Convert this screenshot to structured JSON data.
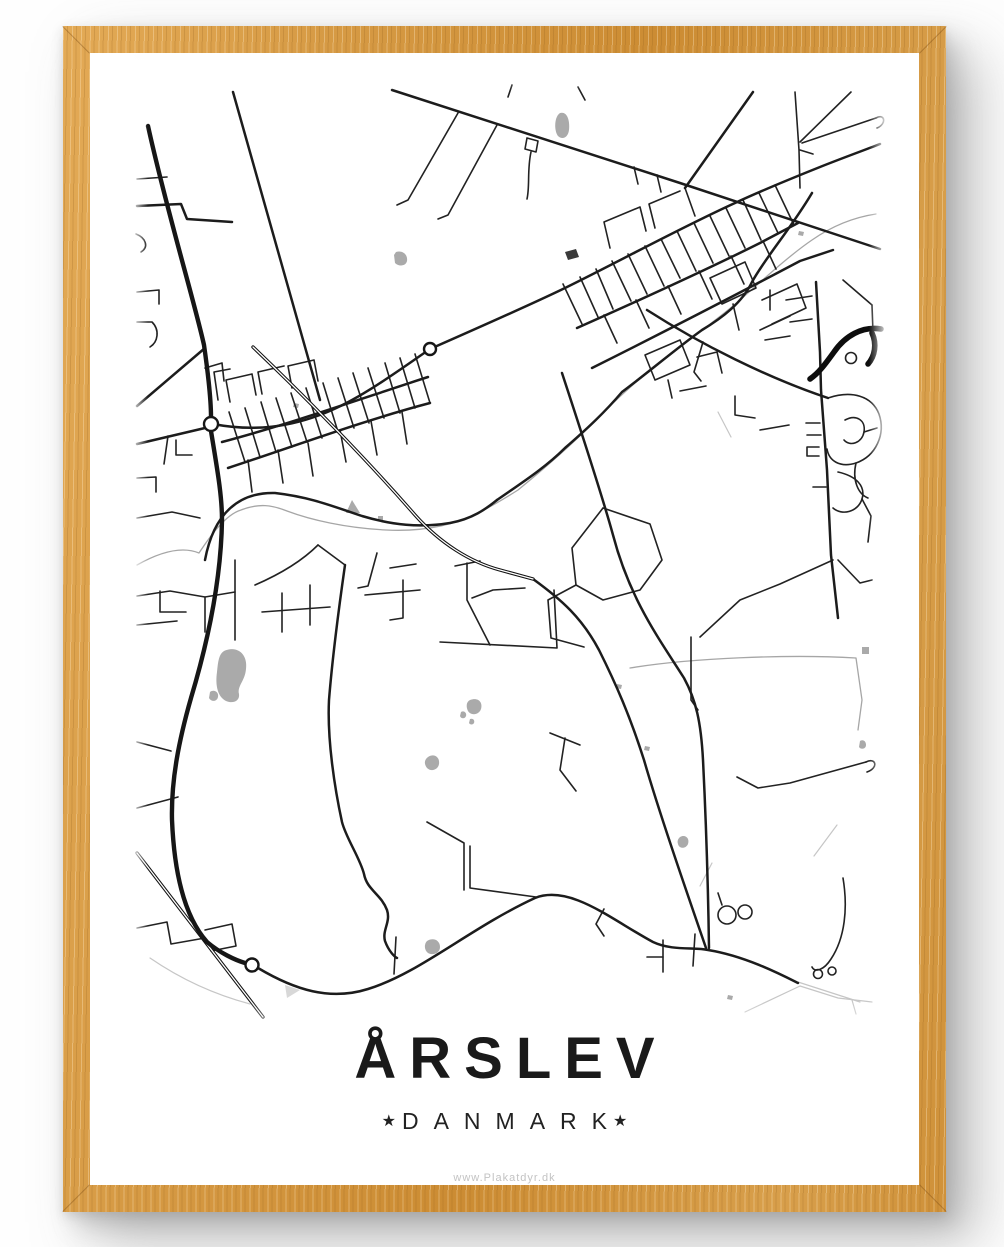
{
  "poster": {
    "title": "ÅRSLEV",
    "subtitle": "DANMARK",
    "subtitle_star": "★",
    "watermark": "www.Plakatdyr.dk"
  },
  "frame": {
    "wood_color": "#d69a44",
    "wood_highlight": "#e3aa56",
    "wood_shadow_edge": "#cc8c33",
    "drop_shadow": "rgba(125,125,125,0.45)",
    "icon": "wood-frame"
  },
  "map": {
    "viewbox": "90 53 829 1132",
    "road_color": "#1c1c1c",
    "stream_color": "#a6a6a6",
    "pond_color": "#aaaaaa",
    "major_roads": [
      "M148,126 C166,208 194,300 204,345 C209,380 211,400 211,417",
      "M211,431 C217,468 222,495 222,520 C221,585 206,648 191,698 C179,740 171,780 172,820 C174,868 183,915 207,942 C220,953 235,960 245,963"
    ],
    "thick_roads": [
      "M881,329 C862,326 845,336 834,352 C826,363 819,373 810,379",
      "M872,333 C877,344 875,356 868,364"
    ],
    "main_roads": [
      "M213,424 C255,432 290,427 325,413 C360,399 395,373 430,349",
      "M430,349 C480,327 530,305 565,288 C620,261 680,228 735,203 C765,189 795,177 820,167 C840,159 862,151 880,144",
      "M392,90 L680,183 L880,249",
      "M258,968 C295,990 330,1001 368,989 C420,973 470,928 535,898 C570,884 612,920 653,942 C672,951 694,947 708,950 C745,956 780,974 798,983",
      "M222,442 C290,424 360,399 428,377",
      "M228,468 C295,446 365,420 430,403",
      "M577,328 C640,300 700,273 760,243 L798,223",
      "M592,368 C660,334 730,298 800,261 L833,250",
      "M205,560 C214,512 240,492 275,493 C310,497 332,506 362,516 C392,525 420,528 450,523 C472,519 486,509 497,500",
      "M497,500 C520,484 545,468 565,448 C588,428 605,412 622,392 C645,375 677,348 702,330 C722,318 742,303 752,282 C765,258 790,230 812,193",
      "M647,310 C700,344 768,378 828,398",
      "M816,282 L820,352 L821,390 L827,470 L831,555 L838,618",
      "M562,373 C584,440 604,502 613,535 C630,600 660,640 684,678 C696,700 701,722 703,760 C706,820 708,880 709,948",
      "M533,579 C562,600 582,618 599,650 C616,684 630,716 644,760 C659,812 686,890 706,948",
      "M345,565 C340,600 333,650 329,700 C327,740 335,790 342,822 C346,838 360,858 364,874 C367,890 381,894 387,910 C391,922 382,930 385,941 C389,952 395,957 397,958",
      "M753,92 L685,188",
      "M233,92 L320,400",
      "M137,406 L205,348",
      "M137,444 L205,428",
      "M137,206 L181,204 L187,219 L232,222"
    ],
    "minor_roads": [
      "M563,284 L582,324",
      "M580,277 L598,317",
      "M596,269 L613,309",
      "M612,261 L631,301",
      "M628,254 L647,294",
      "M645,246 L664,286",
      "M661,239 L680,278",
      "M677,231 L696,271",
      "M694,223 L713,263",
      "M710,216 L729,256",
      "M726,208 L745,248",
      "M743,200 L761,240",
      "M759,193 L778,233",
      "M775,185 L794,225",
      "M604,315 L617,343",
      "M636,300 L649,328",
      "M668,286 L681,314",
      "M699,271 L712,299",
      "M731,256 L744,284",
      "M763,241 L776,269",
      "M229,412 L245,462",
      "M245,408 L260,457",
      "M261,402 L276,452",
      "M276,398 L292,447",
      "M291,393 L307,442",
      "M306,388 L322,438",
      "M323,383 L338,432",
      "M338,378 L354,428",
      "M353,373 L369,423",
      "M368,368 L384,418",
      "M385,363 L400,413",
      "M400,358 L415,408",
      "M415,354 L430,403",
      "M248,460 L252,492",
      "M278,450 L283,483",
      "M308,443 L313,476",
      "M340,430 L346,462",
      "M371,421 L377,455",
      "M402,412 L407,444",
      "M458,113 L408,200 L397,205",
      "M497,125 L448,215 L438,219",
      "M508,97 L512,85",
      "M585,100 L578,87",
      "M634,167 L638,184",
      "M657,175 L661,192",
      "M527,138 L538,141 L536,152 L525,149 L527,138",
      "M531,152 C527,170 530,186 527,199",
      "M795,92 L799,150 L800,188",
      "M800,150 L813,154",
      "M802,143 L876,118",
      "M876,118 C885,113 887,124 877,128",
      "M851,92 L800,142",
      "M610,248 L604,222 L640,207 L646,231",
      "M655,228 L649,204 L680,191",
      "M685,188 L695,216",
      "M710,278 L745,262 L756,288 L722,304 L710,278",
      "M762,300 L797,284 L806,308 L772,324",
      "M733,304 L739,330",
      "M760,330 L790,316",
      "M645,355 L680,340 L690,365 L655,380 L645,355",
      "M668,380 L672,398",
      "M703,342 L694,372 L701,381",
      "M786,300 L812,296",
      "M790,322 L812,319",
      "M770,310 L770,290",
      "M765,340 L790,336",
      "M820,423 L806,423",
      "M821,435 L807,435",
      "M819,447 L807,447 L807,456 L819,456",
      "M826,487 L813,487",
      "M838,560 L860,583 L872,580",
      "M828,398 C852,390 872,396 879,414 C886,434 876,456 856,463 C840,468 829,461 827,449",
      "M845,420 C856,414 866,420 864,432 C862,443 850,447 844,440",
      "M856,463 C852,480 858,494 868,498",
      "M838,472 C856,476 866,486 862,499 C858,512 842,516 833,508",
      "M862,499 L871,516 L868,542",
      "M864,432 L877,428",
      "M697,357 L717,352 L722,373",
      "M680,391 L706,386",
      "M735,396 L735,415 L755,418",
      "M760,430 L789,425",
      "M833,560 L780,584 L740,600 L700,637",
      "M691,637 L691,700 L698,710",
      "M603,508 L650,524 L662,560 L640,590 L603,600 L576,585 L572,548 L603,508",
      "M576,585 L548,600 L551,638 L584,647",
      "M440,642 L557,648 L554,590",
      "M472,598 L493,590 L525,588",
      "M467,563 L467,600 L490,645",
      "M455,566 L480,561",
      "M137,596 L170,591 L205,597 L235,592",
      "M205,597 L205,632",
      "M235,560 L235,640",
      "M137,625 L177,621",
      "M160,591 L160,612 L186,612",
      "M255,585 C285,572 305,558 318,545",
      "M318,545 L345,565",
      "M262,612 L330,607",
      "M282,593 L282,632",
      "M310,585 L310,625",
      "M377,553 L368,586 L358,588",
      "M390,568 L416,564",
      "M403,580 L403,618 L390,620",
      "M365,595 L420,590",
      "M137,179 L167,177",
      "M136,234 C146,238 149,247 141,252",
      "M137,292 L159,290 L159,304",
      "M137,322 L152,322 C160,330 158,342 150,347",
      "M168,436 L164,464",
      "M137,478 L156,477 L156,492",
      "M137,518 L172,512 L200,518",
      "M230,402 L226,380 L252,374 L256,395",
      "M262,394 L258,372 L284,366",
      "M292,388 L288,366 L314,360 L318,381",
      "M218,400 L214,372 L230,369",
      "M205,368 L222,363 L224,381",
      "M176,440 L176,455 L192,455",
      "M137,742 L171,751",
      "M137,808 L178,797",
      "M137,928 L167,922 L171,944 L205,938",
      "M205,930 L232,924 L236,946 L211,951",
      "M396,937 L394,974",
      "M695,934 L693,966",
      "M427,822 L464,843 L464,890",
      "M470,846 L470,888 L536,897",
      "M737,777 L758,788 L790,783 L866,762",
      "M866,762 C876,757 879,768 867,772",
      "M843,878 C848,908 845,938 831,959 C824,970 815,973 812,967",
      "M604,909 L596,924 L604,936",
      "M663,940 L663,972",
      "M663,957 L647,957",
      "M550,733 L580,745",
      "M565,738 L560,770 L576,791",
      "M722,905 L718,893",
      "M872,305 L873,332",
      "M843,280 L872,305"
    ],
    "railways": [
      "M253,347 C300,392 360,452 415,515 C440,543 470,562 500,570 L533,579",
      "M137,853 L263,1017"
    ],
    "streams": [
      "M137,565 C160,552 182,546 199,553 C207,541 224,515 241,510 C259,503 272,505 287,511 C311,520 346,528 386,530 C426,532 456,524 478,513 C494,505 507,497 518,490 C540,472 566,450 591,425 C612,403 640,378 665,358 C690,338 715,322 740,300 C765,278 790,255 812,240 C835,224 856,217 876,214",
      "M630,668 C690,658 790,654 856,658 L862,700 L858,730"
    ],
    "streams_light": [
      "M150,958 C185,982 220,996 250,1004",
      "M798,982 L860,1002",
      "M745,1012 L800,986",
      "M800,986 L838,998 L872,1002",
      "M852,1000 L856,1014",
      "M718,412 L731,437",
      "M837,825 L814,856",
      "M712,863 L700,886"
    ],
    "ponds": [
      "M560,113 C567,111 570,120 569,130 C568,138 562,140 558,136 C554,131 554,117 560,113 Z",
      "M396,252 C403,250 408,255 407,261 C406,266 399,267 395,263 L394,255 Z",
      "M352,500 L360,513 L346,513 Z",
      "M378,516 L383,516 L383,521 L378,521 Z",
      "M294,403 L299,404 L298,408 L293,407 Z",
      "M224,651 C237,645 248,654 246,669 C245,681 237,686 239,694 C240,701 233,704 226,701 C218,697 215,686 217,672 C218,661 219,654 224,651 Z",
      "M210,692 C214,689 219,692 218,697 C217,702 211,702 209,698 Z",
      "M470,700 C478,697 483,702 481,709 C479,715 471,716 468,711 C466,707 466,702 470,700 Z",
      "M461,712 C464,710 467,713 466,716 C465,719 461,719 460,716 Z",
      "M470,719 C473,718 475,720 474,723 C473,725 470,725 469,723 Z",
      "M428,757 C434,753 440,757 439,764 C438,770 431,772 427,768 C424,764 424,760 428,757 Z",
      "M680,837 C685,834 690,838 688,844 C686,849 679,849 678,844 C677,841 678,839 680,837 Z",
      "M860,741 C863,739 866,741 866,745 C866,749 861,750 859,747 Z",
      "M427,941 C433,937 440,940 440,947 C440,953 433,956 428,953 C424,950 424,944 427,941 Z",
      "M728,995 L733,996 L732,1000 L727,999 Z",
      "M617,684 L622,685 L621,689 L616,688 Z",
      "M645,746 L650,747 L649,751 L644,750 Z",
      "M799,231 L804,232 L803,236 L798,235 Z",
      "M862,647 L869,647 L869,654 L862,654 Z"
    ],
    "ponds_light": [
      "M285,985 L300,990 L287,998 Z"
    ],
    "ponds_dark": [
      "M565,252 L576,249 L579,257 L568,260 Z"
    ],
    "roundabouts": [
      {
        "cx": 211,
        "cy": 424,
        "r": 7
      },
      {
        "cx": 430,
        "cy": 349,
        "r": 6
      },
      {
        "cx": 252,
        "cy": 965,
        "r": 6.5
      }
    ],
    "loops": [
      {
        "cx": 818,
        "cy": 974,
        "r": 4.5
      },
      {
        "cx": 832,
        "cy": 971,
        "r": 4
      },
      {
        "cx": 727,
        "cy": 915,
        "r": 9
      },
      {
        "cx": 745,
        "cy": 912,
        "r": 7
      },
      {
        "cx": 851,
        "cy": 358,
        "r": 5.5
      }
    ]
  }
}
